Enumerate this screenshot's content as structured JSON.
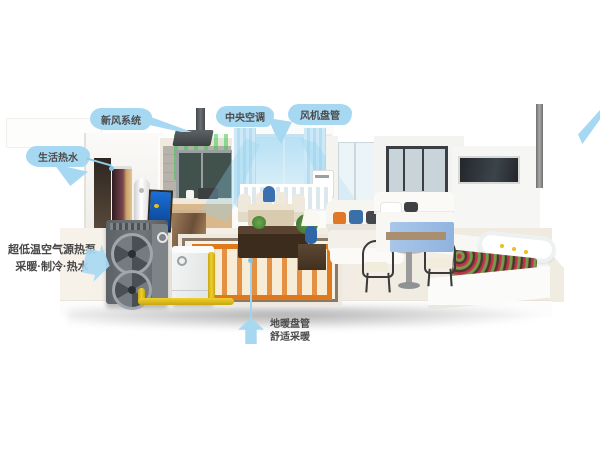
{
  "callouts": {
    "fresh_air": "新风系统",
    "central_ac": "中央空调",
    "fan_coil": "风机盘管",
    "hot_water": "生活热水",
    "heat_pump_line1": "超低温空气源热泵",
    "heat_pump_line2": "采暖·制冷·热水",
    "floor_heating_line1": "地暖盘管",
    "floor_heating_line2": "舒适采暖"
  },
  "colors": {
    "background": "#ffffff",
    "callout_bubble": "#a7d8f2",
    "callout_text": "#4c4c4c",
    "pipe_yellow": "#e9c51d",
    "rug_orange": "#e0791b",
    "airflow_blue": "#8fd0ef",
    "fresh_air_green": "#3ec452",
    "outdoor_unit_gray": "#686d71",
    "flower_red": "#c23050"
  }
}
